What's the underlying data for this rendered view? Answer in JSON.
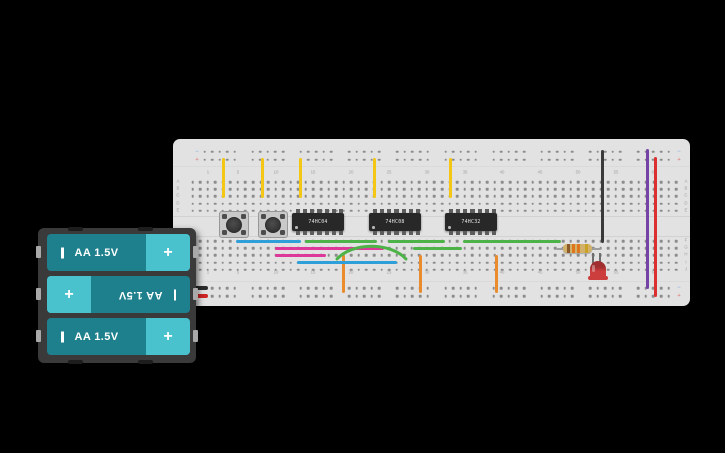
{
  "board": {
    "rail_minus_symbol": "−",
    "rail_plus_symbol": "+",
    "column_labels": [
      {
        "col": 2,
        "text": "1"
      },
      {
        "col": 6,
        "text": "5"
      },
      {
        "col": 11,
        "text": "10"
      },
      {
        "col": 16,
        "text": "15"
      },
      {
        "col": 21,
        "text": "20"
      },
      {
        "col": 26,
        "text": "25"
      },
      {
        "col": 31,
        "text": "30"
      },
      {
        "col": 36,
        "text": "35"
      },
      {
        "col": 41,
        "text": "40"
      },
      {
        "col": 46,
        "text": "45"
      },
      {
        "col": 51,
        "text": "50"
      },
      {
        "col": 56,
        "text": "55"
      },
      {
        "col": 61,
        "text": "60"
      }
    ],
    "row_labels_top": [
      "A",
      "B",
      "C",
      "D",
      "E"
    ],
    "row_labels_bottom": [
      "F",
      "G",
      "H",
      "I",
      "J"
    ],
    "layout": {
      "x": 173,
      "y": 139,
      "w": 517,
      "h": 167,
      "col0": 192.5,
      "dx": 7.56,
      "cols": 65,
      "row_ys_top": [
        182,
        189.2,
        196.4,
        203.6,
        210.8
      ],
      "row_ys_bottom": [
        241,
        248.2,
        255.4,
        262.6,
        269.8
      ],
      "rail_ys_top": [
        151.5,
        159.5
      ],
      "rail_ys_bottom": [
        288,
        296
      ],
      "rail0": 204.5,
      "rail_group_dx": 48.2,
      "col_label_ys": [
        172.5,
        272.5
      ],
      "row_label_xs": [
        178,
        686
      ],
      "rail_marker_xs": [
        196.5,
        678.5
      ],
      "channel_ys": [
        215.5,
        235.5
      ],
      "section_ys": [
        165.5,
        280.5
      ]
    }
  },
  "chips": [
    {
      "label": "74HC04",
      "x": 292
    },
    {
      "label": "74HC08",
      "x": 369
    },
    {
      "label": "74HC32",
      "x": 445
    }
  ],
  "chip_layout": {
    "y": 213,
    "w": 52,
    "h": 18,
    "pins": 7
  },
  "buttons": [
    {
      "x": 219
    },
    {
      "x": 258
    }
  ],
  "button_layout": {
    "y": 211,
    "w": 30,
    "h": 27
  },
  "wires": [
    {
      "name": "wire-yellow-1",
      "color": "#f3c713",
      "x1": 223,
      "y1": 158,
      "x2": 223,
      "y2": 198
    },
    {
      "name": "wire-yellow-2",
      "color": "#f3c713",
      "x1": 262,
      "y1": 158,
      "x2": 262,
      "y2": 198
    },
    {
      "name": "wire-yellow-3",
      "color": "#f3c713",
      "x1": 300,
      "y1": 158,
      "x2": 300,
      "y2": 198
    },
    {
      "name": "wire-yellow-4",
      "color": "#f3c713",
      "x1": 374,
      "y1": 158,
      "x2": 374,
      "y2": 198
    },
    {
      "name": "wire-yellow-5",
      "color": "#f3c713",
      "x1": 450,
      "y1": 158,
      "x2": 450,
      "y2": 198
    },
    {
      "name": "wire-black-top",
      "color": "#3a3a3a",
      "x1": 602,
      "y1": 150,
      "x2": 602,
      "y2": 243
    },
    {
      "name": "wire-purple",
      "color": "#7443a5",
      "x1": 647,
      "y1": 149,
      "x2": 647,
      "y2": 289
    },
    {
      "name": "wire-red",
      "color": "#dc2f2f",
      "x1": 655,
      "y1": 157,
      "x2": 655,
      "y2": 297
    },
    {
      "name": "wire-orange-1",
      "color": "#ea8c2e",
      "x1": 343,
      "y1": 255,
      "x2": 343,
      "y2": 293
    },
    {
      "name": "wire-orange-2",
      "color": "#ea8c2e",
      "x1": 420,
      "y1": 255,
      "x2": 420,
      "y2": 293
    },
    {
      "name": "wire-orange-3",
      "color": "#ea8c2e",
      "x1": 496,
      "y1": 255,
      "x2": 496,
      "y2": 293
    },
    {
      "name": "wire-blue-1",
      "color": "#2e9fd9",
      "x1": 236,
      "y1": 241,
      "x2": 301,
      "y2": 241
    },
    {
      "name": "wire-green-1",
      "color": "#4db348",
      "x1": 305,
      "y1": 241,
      "x2": 377,
      "y2": 241
    },
    {
      "name": "wire-green-2",
      "color": "#4db348",
      "x1": 388,
      "y1": 241,
      "x2": 445,
      "y2": 241
    },
    {
      "name": "wire-green-3",
      "color": "#4db348",
      "x1": 463,
      "y1": 241,
      "x2": 561,
      "y2": 241
    },
    {
      "name": "wire-magenta-1",
      "color": "#dd3899",
      "x1": 275,
      "y1": 248,
      "x2": 384,
      "y2": 248
    },
    {
      "name": "wire-green-4",
      "color": "#4db348",
      "x1": 413,
      "y1": 248,
      "x2": 462,
      "y2": 248
    },
    {
      "name": "wire-magenta-2",
      "color": "#dd3899",
      "x1": 275,
      "y1": 255,
      "x2": 326,
      "y2": 255
    },
    {
      "name": "wire-blue-2",
      "color": "#2e9fd9",
      "x1": 297,
      "y1": 262,
      "x2": 397,
      "y2": 262
    },
    {
      "name": "wire-green-arc",
      "color": "#4db348",
      "arc": true,
      "x1": 337,
      "y1": 259,
      "x2": 406,
      "y2": 259,
      "peak_y": 244
    },
    {
      "name": "battery-lead-black",
      "color": "#2b2b2b",
      "x1": 191,
      "y1": 288,
      "x2": 208,
      "y2": 288,
      "w": 4
    },
    {
      "name": "battery-lead-red",
      "color": "#cf2525",
      "x1": 191,
      "y1": 296,
      "x2": 208,
      "y2": 296,
      "w": 4
    }
  ],
  "resistor": {
    "body_color": "#d2b26a",
    "bands": [
      "#8a5a2a",
      "#e0761c",
      "#e0761c",
      "#c9a227"
    ]
  },
  "led": {
    "color": "#cc3d3d",
    "dark": "#a02e2e"
  },
  "battery_pack": {
    "plus_symbol": "+",
    "cells": [
      {
        "label": "AA 1.5V",
        "flipped": false
      },
      {
        "label": "AA 1.5V",
        "flipped": true
      },
      {
        "label": "AA 1.5V",
        "flipped": false
      }
    ]
  },
  "colors": {
    "background": "#000000",
    "board": "#e2e2e2",
    "hole": "#8c8c8c",
    "board_label": "#a0a0a0",
    "rail_minus": "#8fb3dc",
    "rail_plus": "#e08a8a",
    "channel_line": "#d2d2d2",
    "chip_body": "#282828",
    "chip_pin": "#5d5d5d",
    "battery_body": "#1f808d",
    "battery_cap": "#4ac2ce"
  }
}
